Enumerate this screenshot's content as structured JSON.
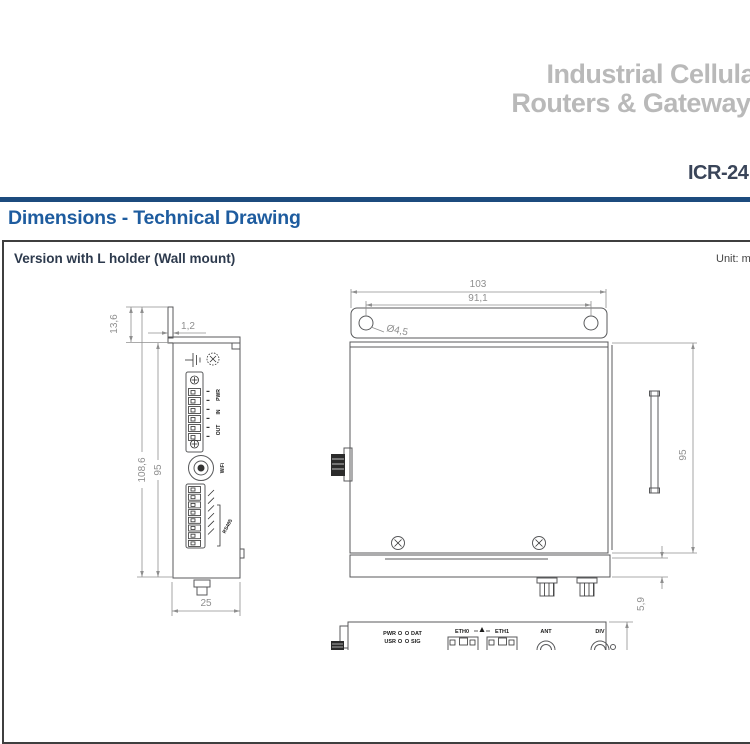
{
  "header": {
    "title_line1": "Industrial Cellular",
    "title_line2": "Routers & Gateways",
    "product_code": "ICR-24"
  },
  "section": {
    "heading": "Dimensions - Technical Drawing",
    "variant_label": "Version with L holder (Wall mount)",
    "unit_label": "Unit: mm"
  },
  "drawing": {
    "side_view": {
      "dim_bracket_offset": "13,6",
      "dim_bracket_thickness": "1,2",
      "dim_overall_height": "108,6",
      "dim_body_height": "95",
      "dim_depth": "25",
      "label_pwr": "PWR",
      "label_in": "IN",
      "label_out": "OUT",
      "label_wifi": "WiFi",
      "label_serial": "RS485"
    },
    "front_view": {
      "dim_overall_width": "103",
      "dim_hole_spacing": "91,1",
      "dim_hole_diameter": "Ø4,5",
      "dim_body_height": "95",
      "dim_holder_thickness": "5,9"
    },
    "bottom_view": {
      "led_pwr": "PWR",
      "led_dat": "DAT",
      "led_usr": "USR",
      "led_sig": "SIG",
      "port_eth0": "ETH0",
      "port_eth1": "ETH1",
      "ant": "ANT",
      "div": "DIV"
    }
  },
  "colors": {
    "heading_blue": "#1e5c9f",
    "rule_blue": "#1c4b7e",
    "title_gray": "#b9b9b9",
    "navy_text": "#3a4559",
    "drawing_line": "#58595b",
    "dimension_gray": "#8f8f8f"
  }
}
